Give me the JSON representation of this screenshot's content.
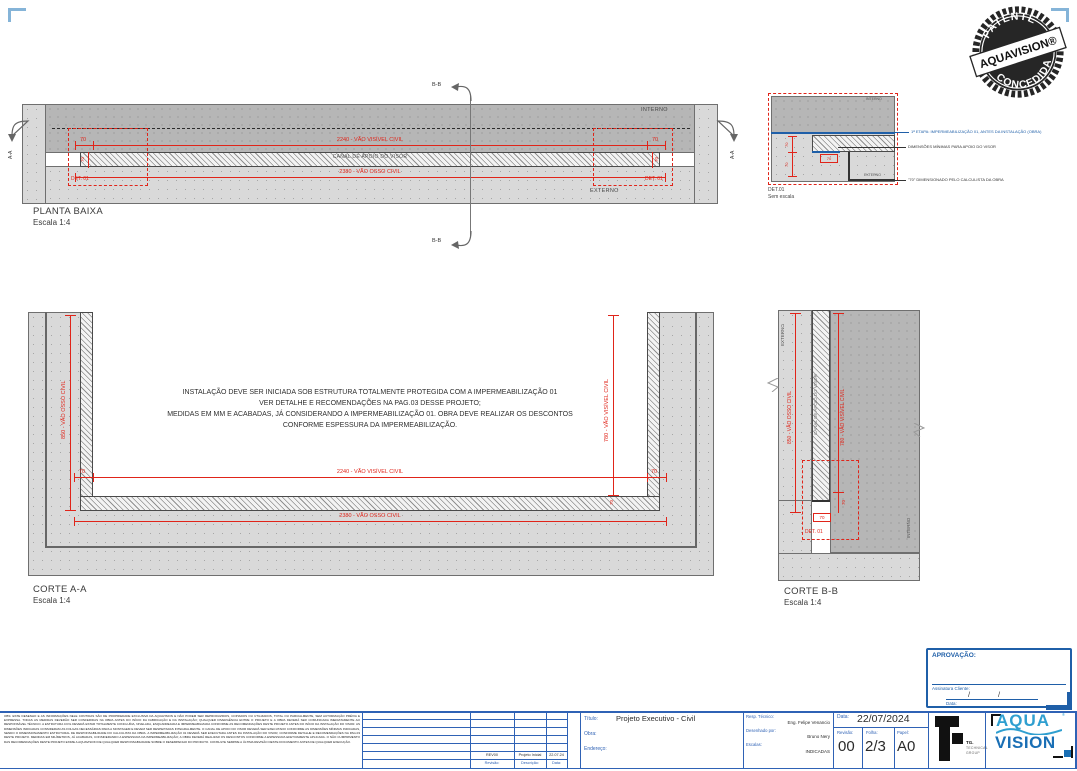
{
  "colors": {
    "red": "#e02419",
    "blue": "#1f5fa8",
    "titleblock_blue": "#2f62b5",
    "corner_blue": "#85b4d8",
    "logo_light_blue": "#2f9fd0",
    "logo_dark_blue": "#1a6fb5"
  },
  "stamp": {
    "arc_top": "PATENTE",
    "band": "AQUAVISION®",
    "arc_bottom": "CONCEDIDA"
  },
  "plan": {
    "title": "PLANTA BAIXA",
    "scale": "Escala 1:4",
    "interno": "INTERNO",
    "externo": "EXTERNO",
    "canal": "CANAL DE APOIO DO VISOR",
    "dim_visivel": "2240 - VÃO VISÍVEL CIVIL",
    "dim_osso": "2380 - VÃO OSSO CIVIL",
    "dim_70": "70",
    "det": "DET. 01",
    "marker_aa": "A-A",
    "marker_bb": "B-B"
  },
  "detail": {
    "label": "DET.01",
    "scale": "Sem escala",
    "interno": "INTERNO",
    "externo": "EXTERNO",
    "dim_70": "70",
    "callout_impermeabilizacao": "1ª ETAPA: IMPERMEABILIZAÇÃO 01, ANTES DA INSTALAÇÃO (OBRA)",
    "callout_dimensoes": "DIMENSÕES MÍNIMAS PARA APOIO DO VISOR",
    "callout_calculista": "\"70\" DIMENSIONADO PELO CALCULISTA DA OBRA"
  },
  "corte_aa": {
    "title": "CORTE A-A",
    "scale": "Escala 1:4",
    "note_line1": "INSTALAÇÃO DEVE SER INICIADA SOB ESTRUTURA TOTALMENTE PROTEGIDA COM A IMPERMEABILIZAÇÃO 01",
    "note_line2": "VER DETALHE E RECOMENDAÇÕES NA PAG.03 DESSE PROJETO;",
    "note_line3": "MEDIDAS EM MM E ACABADAS, JÁ CONSIDERANDO A IMPERMEABILIZAÇÃO 01. OBRA DEVE REALIZAR OS DESCONTOS",
    "note_line4": "CONFORME ESPESSURA DA IMPERMEABILIZAÇÃO.",
    "dim_osso_vert": "850 - VÃO OSSO CIVIL",
    "dim_visivel_vert": "780 - VÃO VISÍVEL CIVIL",
    "dim_visivel_horiz": "2240 - VÃO VISÍVEL CIVIL",
    "dim_osso_horiz": "2380 - VÃO OSSO CIVIL",
    "dim_70": "70"
  },
  "corte_bb": {
    "title": "CORTE B-B",
    "scale": "Escala 1:4",
    "externo": "EXTERNO",
    "interno": "INTERNO",
    "canal": "CANAL DE APOIO DO VISOR",
    "dim_osso_vert": "850 - VÃO OSSO CIVIL",
    "dim_visivel_vert": "780 - VÃO VISÍVEL CIVIL",
    "dim_70": "70",
    "det": "DET. 01"
  },
  "approval": {
    "title": "APROVAÇÃO:",
    "signature_label": "Assinatura Cliente:",
    "date_label": "Data:",
    "date_slash": "/"
  },
  "fine_print": "OBS: ESTE DESENHO E AS INFORMAÇÕES NELE CONTIDAS SÃO DE PROPRIEDADE EXCLUSIVA DA AQUAVISION E NÃO PODEM SER REPRODUZIDOS, COPIADOS OU UTILIZADOS, TOTAL OU PARCIALMENTE, SEM AUTORIZAÇÃO PRÉVIA E EXPRESSA. TODAS AS MEDIDAS DEVERÃO SER CONFERIDAS NA OBRA ANTES DO INÍCIO DA FABRICAÇÃO E DA INSTALAÇÃO; QUALQUER DIVERGÊNCIA ENTRE O PROJETO E A OBRA DEVERÁ SER COMUNICADA IMEDIATAMENTE AO RESPONSÁVEL TÉCNICO. A ESTRUTURA CIVIL DEVERÁ ESTAR TOTALMENTE CONCLUÍDA, NIVELADA, ESQUADREJADA E IMPERMEABILIZADA CONFORME AS RECOMENDAÇÕES DESTE PROJETO ANTES DO INÍCIO DA INSTALAÇÃO DO VISOR. AS DIMENSÕES INDICADAS CONSIDERAM AS FOLGAS NECESSÁRIAS PARA A MONTAGEM E DEVEM SER RESPEITADAS INTEGRALMENTE. O CANAL DE APOIO DO VISOR DEVERÁ SER EXECUTADO CONFORME AS DIMENSÕES MÍNIMAS INDICADAS, SENDO O DIMENSIONAMENTO ESTRUTURAL DE RESPONSABILIDADE DO CALCULISTA DA OBRA. A IMPERMEABILIZAÇÃO 01 DEVERÁ SER EXECUTADA ANTES DA INSTALAÇÃO DO VISOR, CONFORME DETALHE E RECOMENDAÇÕES NA PAG.03 DESTE PROJETO. MEDIDAS EM MILÍMETROS, JÁ ACABADAS, CONSIDERANDO A ESPESSURA DA IMPERMEABILIZAÇÃO; A OBRA DEVERÁ REALIZAR OS DESCONTOS CONFORME A ESPESSURA EFETIVAMENTE APLICADA. O NÃO CUMPRIMENTO DAS RECOMENDAÇÕES DESTE PROJETO EXIME A AQUAVISION DE QUALQUER RESPONSABILIDADE SOBRE O DESEMPENHO DO PRODUTO. CONSULTE SEMPRE A ÚLTIMA REVISÃO DESTE DOCUMENTO ANTES DE QUALQUER EXECUÇÃO.",
  "revision_table": {
    "header_revisao": "Revisão:",
    "header_descricao": "Descrição:",
    "header_data": "Data:",
    "row_revisao": "REV00",
    "row_descricao": "Projeto Inicial",
    "row_data": "22.07.24"
  },
  "titleblock": {
    "titulo_label": "Título:",
    "titulo": "Projeto Executivo - Civil",
    "obra_label": "Obra:",
    "endereco_label": "Endereço:",
    "resp_label": "Resp. Técnico:",
    "resp": "Eng. Felipe Venancio",
    "desenhado_label": "Desenhado por:",
    "desenhado": "Bruno Nery",
    "escalas_label": "Escalas:",
    "escalas": "INDICADAS",
    "data_label": "Data:",
    "data": "22/07/2024",
    "revisao_label": "Revisão:",
    "revisao": "00",
    "folha_label": "Folha:",
    "folha": "2/3",
    "papel_label": "Papel:",
    "papel": "A0",
    "tg_name": "TG.",
    "tg_sub1": "TECHNICAL",
    "tg_sub2": "GROUP",
    "aqua": "AQUA",
    "vision": "VISION"
  }
}
